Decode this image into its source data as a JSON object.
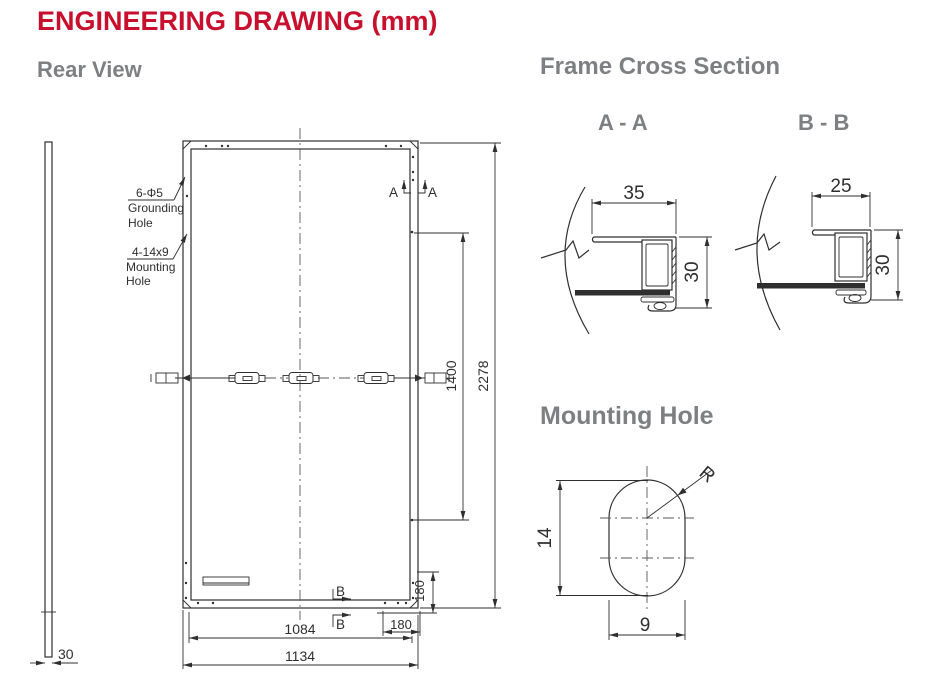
{
  "title": "ENGINEERING DRAWING (mm)",
  "headings": {
    "rear_view": "Rear View",
    "frame_cross_section": "Frame Cross Section",
    "section_aa": "A - A",
    "section_bb": "B - B",
    "mounting_hole": "Mounting Hole"
  },
  "colors": {
    "accent_red": "#c8102e",
    "heading_gray": "#7d7f82",
    "line": "#2f2f2f"
  },
  "rear_view": {
    "callouts": {
      "grounding": {
        "spec": "6-Φ5",
        "line1": "Grounding",
        "line2": "Hole"
      },
      "mounting": {
        "spec": "4-14x9",
        "line1": "Mounting",
        "line2": "Hole"
      }
    },
    "dimensions": {
      "side_thickness": "30",
      "overall_width": "1134",
      "hole_span_width": "1084",
      "hole_edge_offset_h": "180",
      "hole_edge_offset_v": "180",
      "hole_span_height": "1400",
      "overall_height": "2278"
    },
    "section_markers": {
      "a": "A",
      "b": "B"
    }
  },
  "cross_sections": {
    "aa": {
      "width": "35",
      "height": "30"
    },
    "bb": {
      "width": "25",
      "height": "30"
    }
  },
  "mounting_hole_detail": {
    "height": "14",
    "width": "9",
    "radius_label": "R"
  }
}
